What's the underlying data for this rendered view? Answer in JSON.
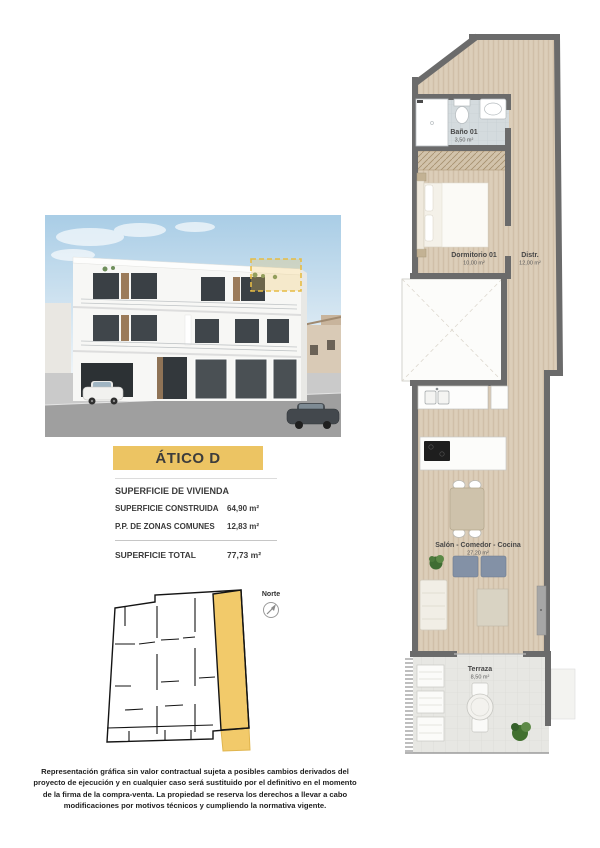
{
  "colors": {
    "accent_yellow": "#ecc463",
    "wall_gray": "#6b6b6b",
    "wood_floor": "#d9cab5",
    "bath_tile": "#d4dbde",
    "terrace_tile": "#e7e7e3"
  },
  "title": {
    "label": "ÁTICO D"
  },
  "surface_table": {
    "header": "SUPERFICIE DE VIVIENDA",
    "rows": [
      {
        "label": "SUPERFICIE CONSTRUIDA",
        "value": "64,90 m²"
      },
      {
        "label": "P.P. DE ZONAS COMUNES",
        "value": "12,83 m²"
      }
    ],
    "total": {
      "label": "SUPERFICIE TOTAL",
      "value": "77,73 m²"
    }
  },
  "key_plan": {
    "north_label": "Norte"
  },
  "floor_plan": {
    "rooms": [
      {
        "name": "Baño 01",
        "area": "3,50 m²"
      },
      {
        "name": "Dormitorio 01",
        "area": "10,00 m²"
      },
      {
        "name": "Distr.",
        "area": "12,00 m²"
      },
      {
        "name": "Salón - Comedor - Cocina",
        "area": "27,20 m²"
      },
      {
        "name": "Terraza",
        "area": "8,50 m²"
      }
    ]
  },
  "disclaimer": "Representación gráfica sin valor contractual sujeta a posibles cambios derivados del proyecto de ejecución y en cualquier caso será sustituido por el definitivo en el momento de la firma de la compra-venta. La propiedad se reserva los derechos a llevar a cabo modificaciones por motivos técnicos y cumpliendo la normativa vigente."
}
